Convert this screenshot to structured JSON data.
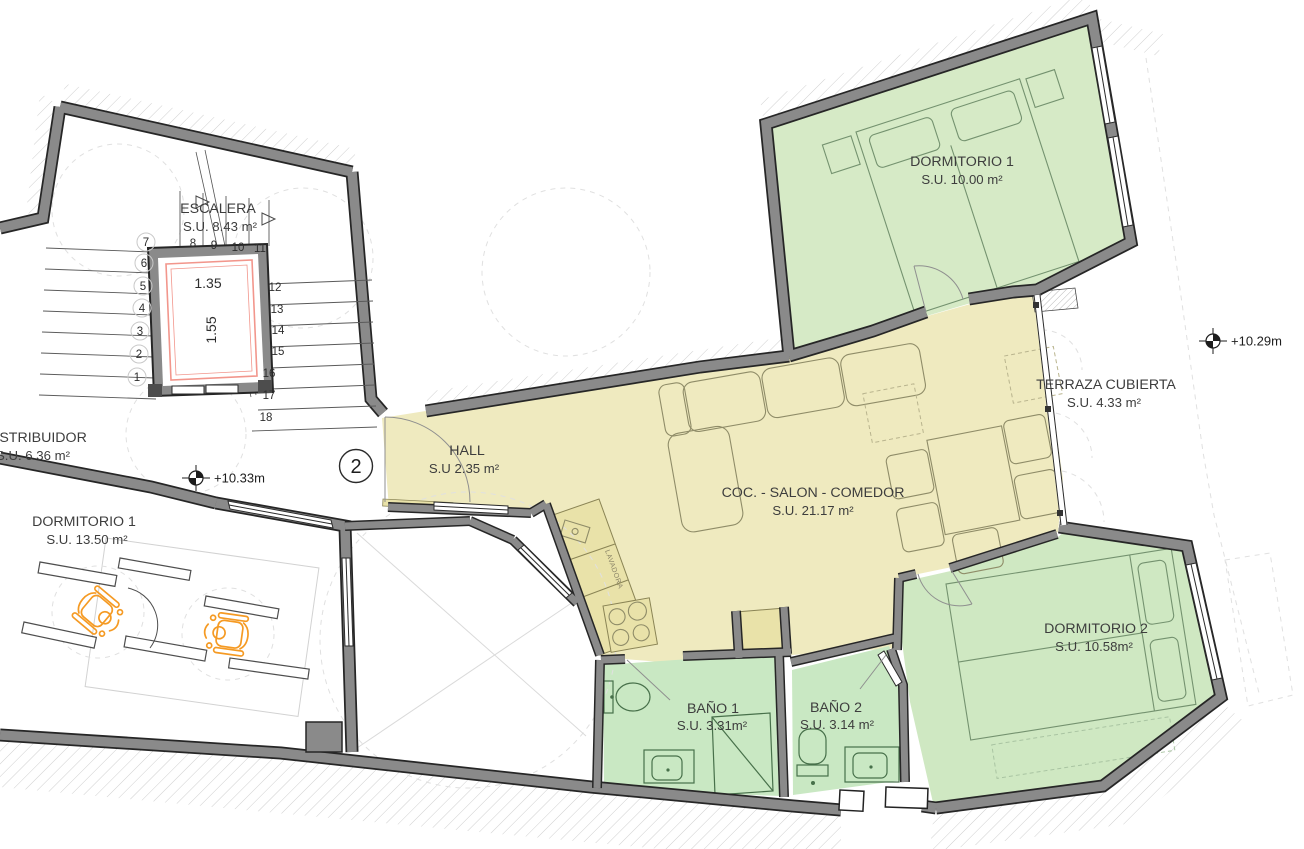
{
  "plan": {
    "unit_number": "2",
    "rooms": {
      "escalera": {
        "name": "ESCALERA",
        "area": "S.U. 8.43 m²"
      },
      "distribuidor": {
        "name": "DISTRIBUIDOR",
        "area": "S.U. 6.36 m²"
      },
      "dormitorio1_izq": {
        "name": "DORMITORIO 1",
        "area": "S.U. 13.50 m²"
      },
      "hall": {
        "name": "HALL",
        "area": "S.U 2.35 m²"
      },
      "salon": {
        "name": "COC. - SALON - COMEDOR",
        "area": "S.U. 21.17 m²"
      },
      "dormitorio1": {
        "name": "DORMITORIO 1",
        "area": "S.U. 10.00 m²"
      },
      "terraza": {
        "name": "TERRAZA CUBIERTA",
        "area": "S.U. 4.33 m²"
      },
      "dormitorio2": {
        "name": "DORMITORIO 2",
        "area": "S.U. 10.58m²"
      },
      "bano1": {
        "name": "BAÑO 1",
        "area": "S.U. 3.31m²"
      },
      "bano2": {
        "name": "BAÑO 2",
        "area": "S.U. 3.14 m²"
      }
    },
    "levels": {
      "distribuidor": "+10.33m",
      "terraza": "+10.29m"
    },
    "elevator": {
      "width": "1.35",
      "depth": "1.55"
    },
    "appliance": {
      "lavadora": "LAVADORA"
    },
    "stair_steps": [
      "1",
      "2",
      "3",
      "4",
      "5",
      "6",
      "7",
      "8",
      "9",
      "10",
      "11",
      "12",
      "13",
      "14",
      "15",
      "16",
      "17",
      "18"
    ],
    "colors": {
      "dormitorio_green": "#d6eac6",
      "dormitorio2_green": "#cfe8c2",
      "bath_green": "#c9e8c3",
      "salon_yellow": "#efeabf",
      "counter_tan": "#e9e2a9",
      "wall_gray": "#8a8a8a",
      "elevator_pink": "#f2968c",
      "accessibility_orange": "#f59a23"
    }
  }
}
